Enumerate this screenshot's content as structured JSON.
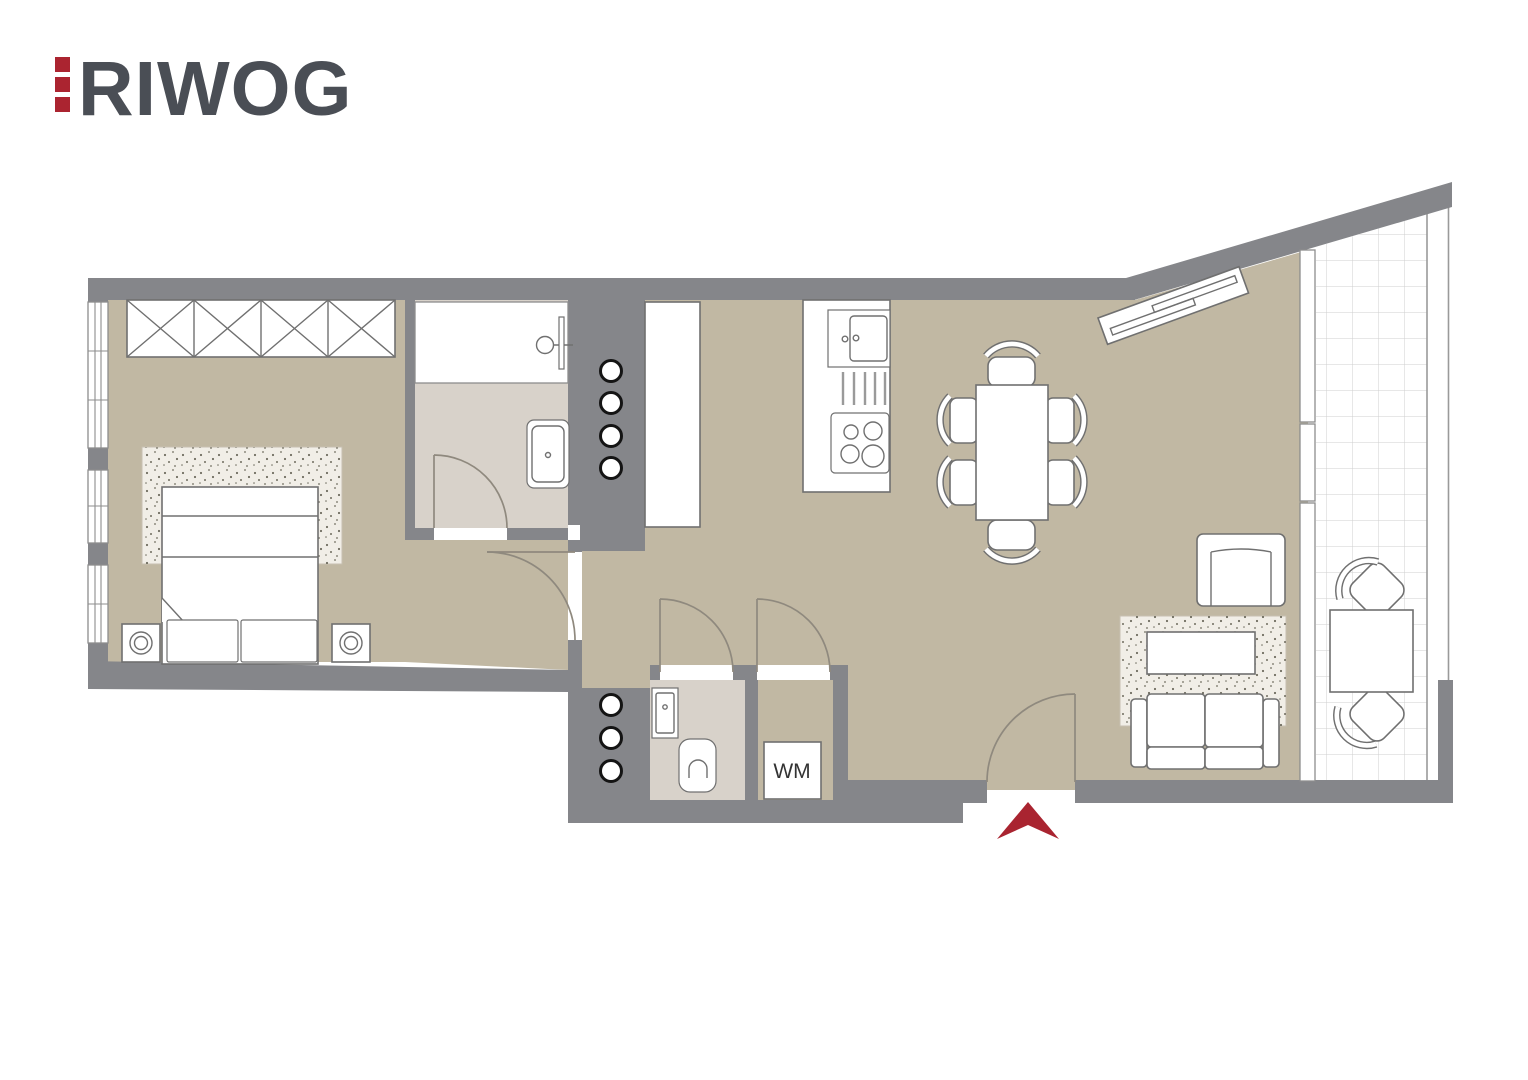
{
  "logo": {
    "text": "RIWOG"
  },
  "labels": {
    "washing_machine": "WM"
  },
  "colors": {
    "wall": "#85868a",
    "floor": "#c1b8a3",
    "wet_floor": "#d8d2ca",
    "furniture_outline": "#707070",
    "door_stroke": "#8f897e",
    "window_frame": "#8d8d8d",
    "balcony_grid": "#cfcfcf",
    "riser_outline": "#141414",
    "speckle": "#6f6d60",
    "arrow_red": "#a92430",
    "logo_red": "#ab2430",
    "logo_gray": "#4a4e55"
  }
}
